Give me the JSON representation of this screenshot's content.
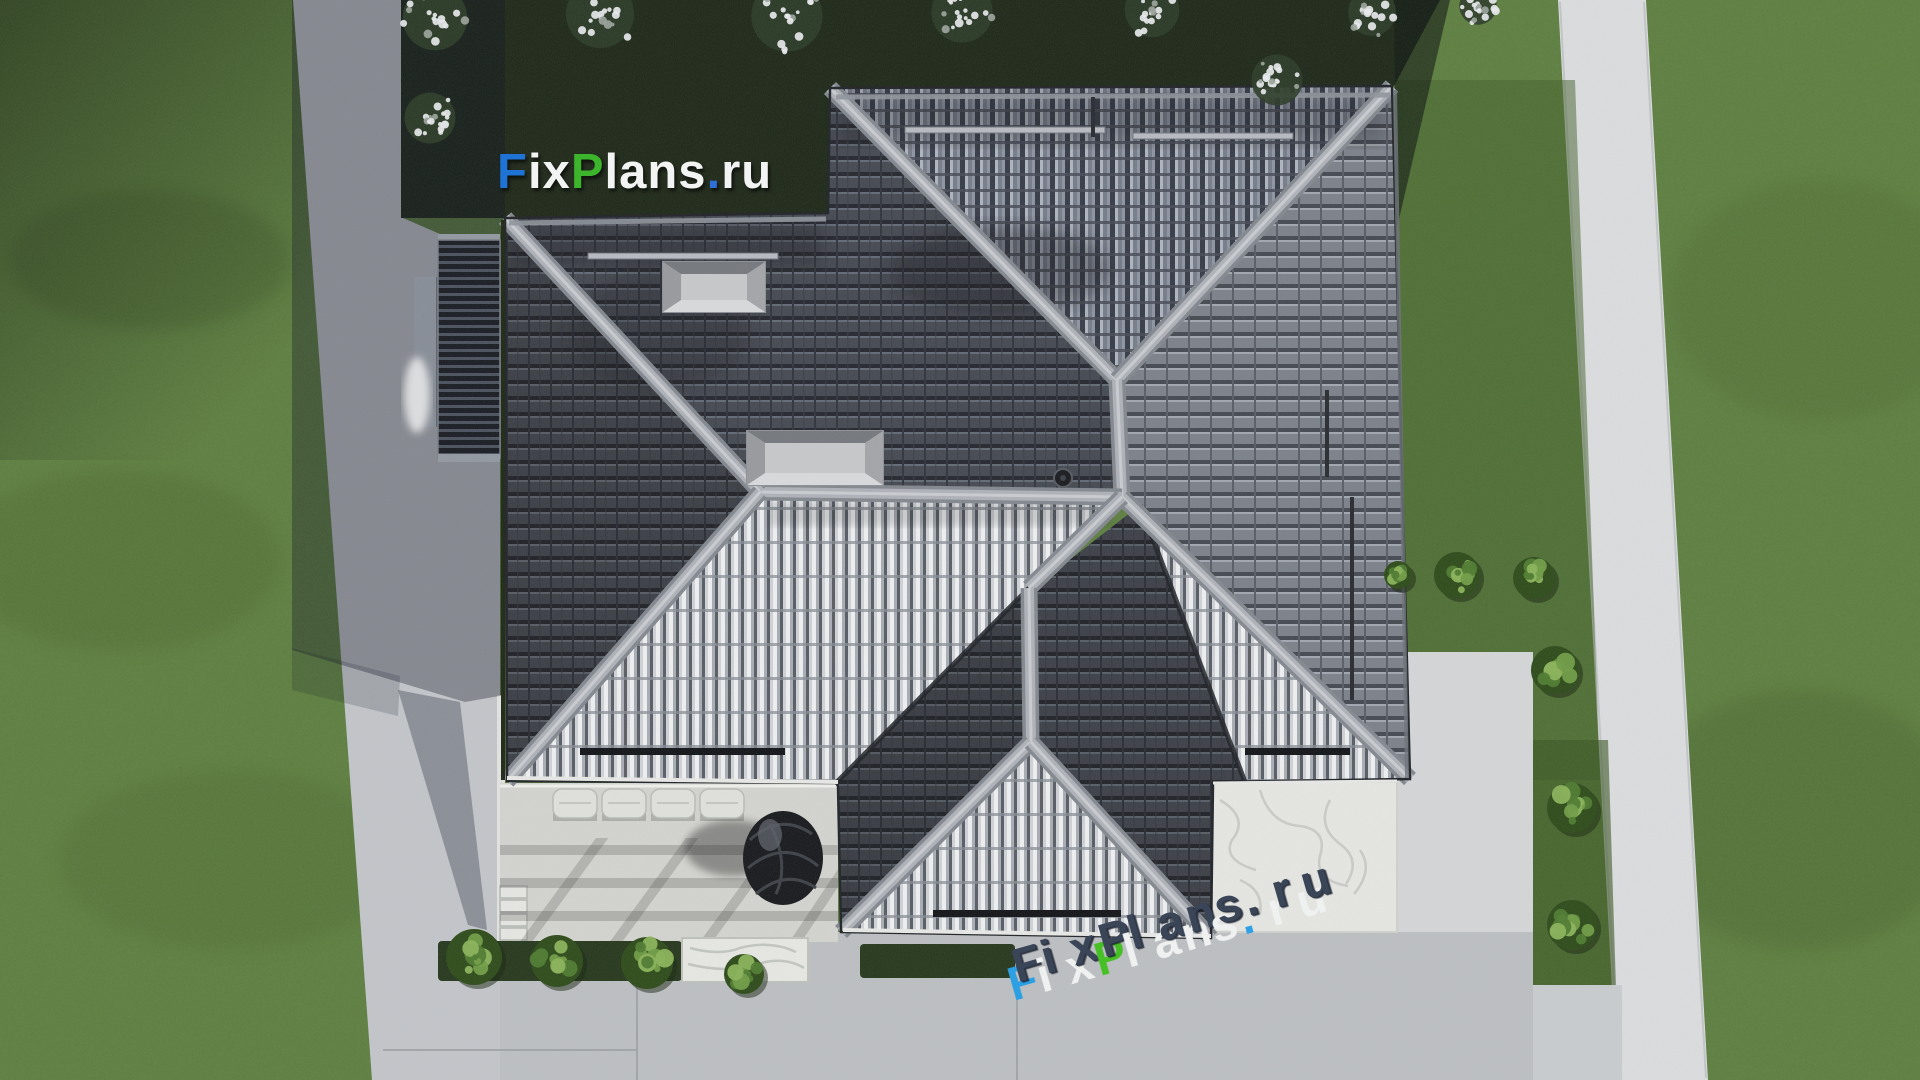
{
  "watermark": {
    "segments": [
      {
        "text": "F",
        "color": "#1e73d4"
      },
      {
        "text": "ix",
        "color": "#f2f3f3"
      },
      {
        "text": "P",
        "color": "#3cb42c"
      },
      {
        "text": "lans",
        "color": "#f2f3f3"
      },
      {
        "text": ".",
        "color": "#2e6fd8"
      },
      {
        "text": "ru",
        "color": "#f2f3f3"
      }
    ]
  },
  "watermark_3d": {
    "body_color": "#3a4557",
    "letters": [
      {
        "ch": "F",
        "face": "#2da0e4"
      },
      {
        "ch": "i",
        "face": "#eff1f1"
      },
      {
        "ch": "x",
        "face": "#eff1f1"
      },
      {
        "ch": "P",
        "face": "#47c026"
      },
      {
        "ch": "l",
        "face": "#eff1f1"
      },
      {
        "ch": "a",
        "face": "#eff1f1"
      },
      {
        "ch": "n",
        "face": "#eff1f1"
      },
      {
        "ch": "s",
        "face": "#eff1f1"
      },
      {
        "ch": ".",
        "face": "#2da0e4"
      },
      {
        "ch": "r",
        "face": "#eff1f1"
      },
      {
        "ch": "u",
        "face": "#eff1f1"
      }
    ]
  },
  "scene": {
    "palette": {
      "lawn": "#5a7c3c",
      "lawn_dark_band": "#1c2616",
      "path_light": "#dbdddf",
      "pavement": "#c2c5c9",
      "terrace": "#d3d4cf",
      "marble": "#e6e7e3",
      "roof_dark": "#43474f",
      "roof_medium": "#7b8089",
      "roof_bright": "#bfc3c8",
      "ridge": "#aeb2b8",
      "shadow": "#0b1020"
    },
    "roof_regions": [
      {
        "name": "north-slope-ne",
        "pattern": "patDarkV",
        "points": "830,88 1392,86 1117,380"
      },
      {
        "name": "east-slope",
        "pattern": "patMed",
        "points": "1392,86 1410,779 1122,497 1117,380"
      },
      {
        "name": "nw-slope",
        "pattern": "patDark",
        "points": "505,218 828,213 830,88 1117,380 1122,497 760,492"
      },
      {
        "name": "west-slope",
        "pattern": "patDark",
        "points": "505,218 760,492 507,781"
      },
      {
        "name": "south-slope-bright",
        "pattern": "patBright",
        "points": "760,492 1122,497 1029,588 836,783 507,781"
      },
      {
        "name": "wing-east-slope",
        "pattern": "patDark",
        "points": "1031,590 1140,505 1245,782 1213,782 1211,938 1031,742"
      },
      {
        "name": "se-bright-band",
        "pattern": "patBright",
        "points": "1128,498 1410,779 1245,782 1140,505"
      },
      {
        "name": "wing-west-slope",
        "pattern": "patDark",
        "points": "1029,588 1031,742 841,932 838,786 836,783"
      },
      {
        "name": "wing-south-slope",
        "pattern": "patBright",
        "points": "1031,742 841,932 1211,938"
      }
    ],
    "region_shades": [
      {
        "points": "505,218 760,492 507,781",
        "opacity": 0.14
      },
      {
        "points": "1029,588 1031,742 841,932 838,786 836,783",
        "opacity": 0.18
      },
      {
        "points": "1031,590 1140,505 1245,782 1213,782 1211,938 1031,742",
        "opacity": 0.12
      }
    ],
    "ridges": [
      {
        "x1": 830,
        "y1": 88,
        "x2": 1117,
        "y2": 380
      },
      {
        "x1": 1392,
        "y1": 86,
        "x2": 1117,
        "y2": 380
      },
      {
        "x1": 1117,
        "y1": 380,
        "x2": 1122,
        "y2": 497
      },
      {
        "x1": 760,
        "y1": 492,
        "x2": 1122,
        "y2": 497
      },
      {
        "x1": 505,
        "y1": 218,
        "x2": 760,
        "y2": 492
      },
      {
        "x1": 760,
        "y1": 492,
        "x2": 507,
        "y2": 781
      },
      {
        "x1": 1122,
        "y1": 497,
        "x2": 1410,
        "y2": 779
      },
      {
        "x1": 1122,
        "y1": 497,
        "x2": 1029,
        "y2": 588
      },
      {
        "x1": 1029,
        "y1": 588,
        "x2": 1031,
        "y2": 742
      },
      {
        "x1": 1031,
        "y1": 742,
        "x2": 841,
        "y2": 932
      },
      {
        "x1": 1031,
        "y1": 742,
        "x2": 1211,
        "y2": 938
      }
    ],
    "valleys": [
      {
        "x1": 1029,
        "y1": 588,
        "x2": 836,
        "y2": 783
      },
      {
        "x1": 1140,
        "y1": 505,
        "x2": 1245,
        "y2": 782
      }
    ],
    "skylights": [
      {
        "x": 663,
        "y": 262,
        "w": 102,
        "h": 50
      },
      {
        "x": 747,
        "y": 431,
        "w": 136,
        "h": 54
      }
    ],
    "snow_bars_light": [
      {
        "x": 905,
        "y": 127,
        "w": 200
      },
      {
        "x": 1133,
        "y": 133,
        "w": 160
      },
      {
        "x": 588,
        "y": 253,
        "w": 190
      }
    ],
    "snow_bars_dark": [
      {
        "x": 580,
        "y": 748,
        "w": 205
      },
      {
        "x": 1245,
        "y": 748,
        "w": 105
      },
      {
        "x": 933,
        "y": 910,
        "w": 188
      }
    ],
    "pipes": [
      {
        "x1": 1327,
        "y1": 390,
        "x2": 1327,
        "y2": 477
      },
      {
        "x1": 1352,
        "y1": 497,
        "x2": 1352,
        "y2": 700
      },
      {
        "x1": 1093,
        "y1": 97,
        "x2": 1093,
        "y2": 137
      }
    ],
    "roof_vent_pipe": {
      "cx": 1063,
      "cy": 478,
      "r": 9
    },
    "loungers": [
      {
        "x": 553,
        "y": 789
      },
      {
        "x": 602,
        "y": 789
      },
      {
        "x": 651,
        "y": 789
      },
      {
        "x": 700,
        "y": 789
      }
    ],
    "bushes": [
      {
        "x": 1457,
        "y": 575,
        "r": 23
      },
      {
        "x": 1534,
        "y": 578,
        "r": 21
      },
      {
        "x": 1398,
        "y": 575,
        "r": 14
      },
      {
        "x": 1555,
        "y": 670,
        "r": 24
      },
      {
        "x": 1572,
        "y": 808,
        "r": 25
      },
      {
        "x": 1572,
        "y": 925,
        "r": 25
      },
      {
        "x": 474,
        "y": 957,
        "r": 28
      },
      {
        "x": 557,
        "y": 961,
        "r": 26
      },
      {
        "x": 647,
        "y": 963,
        "r": 26
      },
      {
        "x": 744,
        "y": 974,
        "r": 20
      }
    ],
    "flower_clusters": [
      {
        "x": 435,
        "y": 18,
        "r": 38
      },
      {
        "x": 430,
        "y": 118,
        "r": 30
      },
      {
        "x": 600,
        "y": 14,
        "r": 40
      },
      {
        "x": 787,
        "y": 16,
        "r": 42
      },
      {
        "x": 962,
        "y": 12,
        "r": 36
      },
      {
        "x": 1152,
        "y": 10,
        "r": 32
      },
      {
        "x": 1277,
        "y": 80,
        "r": 30
      },
      {
        "x": 1372,
        "y": 12,
        "r": 28
      },
      {
        "x": 1478,
        "y": 6,
        "r": 22
      }
    ]
  }
}
